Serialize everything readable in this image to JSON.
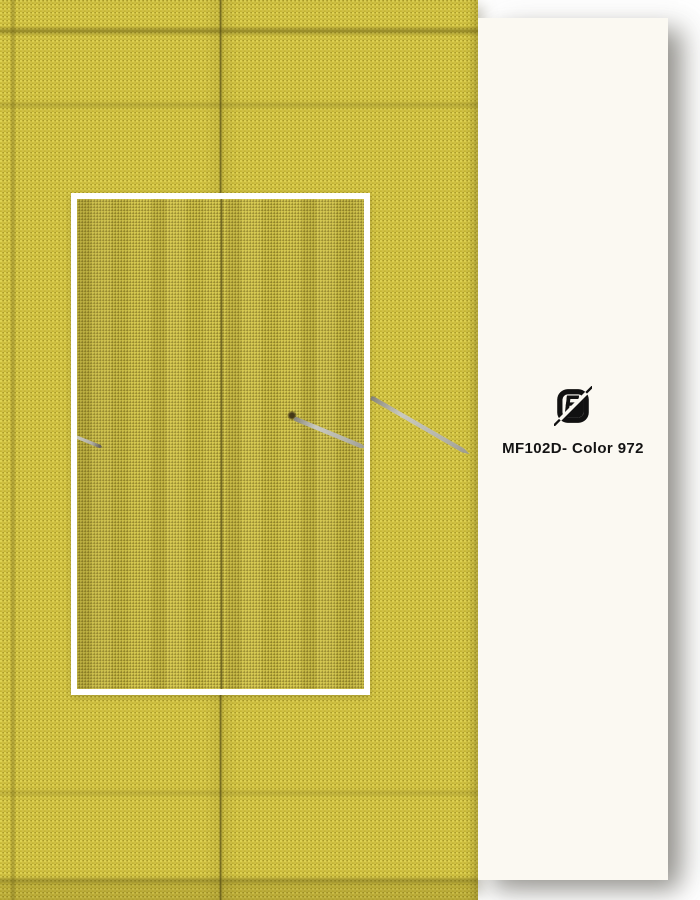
{
  "panel": {
    "label": "MF102D- Color 972",
    "logo_icon": "brand-fabric-monogram-icon"
  },
  "colors": {
    "fabric_base": "#c4b432",
    "fabric_light": "#ddd051",
    "seam_color": "#56500f",
    "panel_bg": "#fbf9f2",
    "label_color": "#141414",
    "frame_color": "#ffffff",
    "pin_color": "#b6b6ac",
    "logo_color": "#111111"
  }
}
